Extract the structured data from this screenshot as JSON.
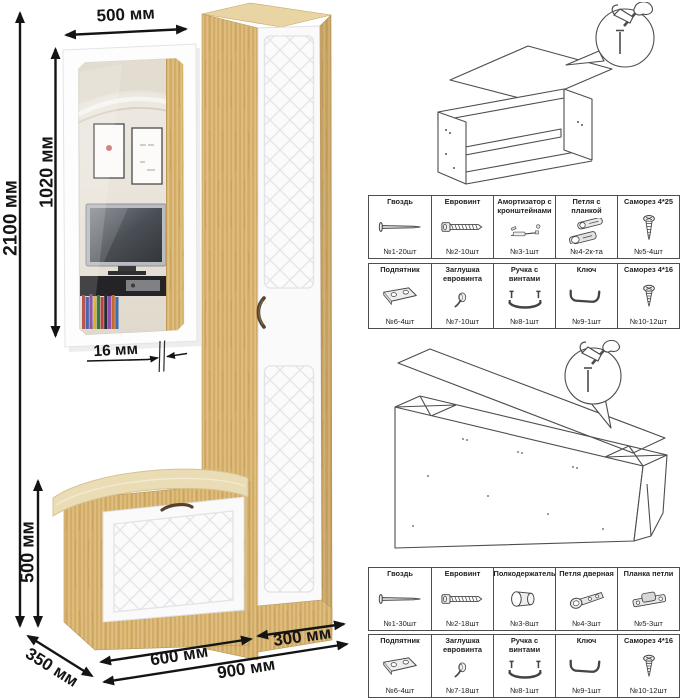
{
  "dimensions": {
    "total_height": "2100 мм",
    "mirror_height": "1020 мм",
    "mirror_width": "500 мм",
    "panel_thickness": "16 мм",
    "bench_height": "500 мм",
    "depth": "350 мм",
    "bench_width": "600 мм",
    "cabinet_width": "300 мм",
    "total_width": "900 мм"
  },
  "colors": {
    "wood": "#D7B26E",
    "facade_white": "#FAFAFB",
    "cushion": "#EADCB5",
    "dimension_ink": "#141414",
    "table_border": "#4F4F4F"
  },
  "bench_kit": {
    "row1": [
      {
        "label": "Гвоздь",
        "icon": "nail-icon",
        "qty": "№1-20шт"
      },
      {
        "label": "Евровинт",
        "icon": "euroscrew-icon",
        "qty": "№2-10шт"
      },
      {
        "label": "Амортизатор с кронштейнами",
        "icon": "gas-strut-icon",
        "qty": "№3-1шт"
      },
      {
        "label": "Петля с планкой",
        "icon": "hinge-with-plate-icon",
        "qty": "№4-2к-та"
      },
      {
        "label": "Саморез 4*25",
        "icon": "screw-icon",
        "qty": "№5-4шт"
      }
    ],
    "row2": [
      {
        "label": "Подпятник",
        "icon": "glide-icon",
        "qty": "№6-4шт"
      },
      {
        "label": "Заглушка евровинта",
        "icon": "cap-icon",
        "qty": "№7-10шт"
      },
      {
        "label": "Ручка с винтами",
        "icon": "handle-icon",
        "qty": "№8-1шт"
      },
      {
        "label": "Ключ",
        "icon": "hex-key-icon",
        "qty": "№9-1шт"
      },
      {
        "label": "Саморез 4*16",
        "icon": "screw-icon",
        "qty": "№10-12шт"
      }
    ]
  },
  "cabinet_kit": {
    "row1": [
      {
        "label": "Гвоздь",
        "icon": "nail-icon",
        "qty": "№1-30шт"
      },
      {
        "label": "Евровинт",
        "icon": "euroscrew-icon",
        "qty": "№2-18шт"
      },
      {
        "label": "Полкодержатель",
        "icon": "shelf-pin-icon",
        "qty": "№3-8шт"
      },
      {
        "label": "Петля дверная",
        "icon": "door-hinge-icon",
        "qty": "№4-3шт"
      },
      {
        "label": "Планка петли",
        "icon": "hinge-plate-icon",
        "qty": "№5-3шт"
      }
    ],
    "row2": [
      {
        "label": "Подпятник",
        "icon": "glide-icon",
        "qty": "№6-4шт"
      },
      {
        "label": "Заглушка евровинта",
        "icon": "cap-icon",
        "qty": "№7-18шт"
      },
      {
        "label": "Ручка с винтами",
        "icon": "handle-icon",
        "qty": "№8-1шт"
      },
      {
        "label": "Ключ",
        "icon": "hex-key-icon",
        "qty": "№9-1шт"
      },
      {
        "label": "Саморез 4*16",
        "icon": "screw-icon",
        "qty": "№10-12шт"
      }
    ]
  }
}
